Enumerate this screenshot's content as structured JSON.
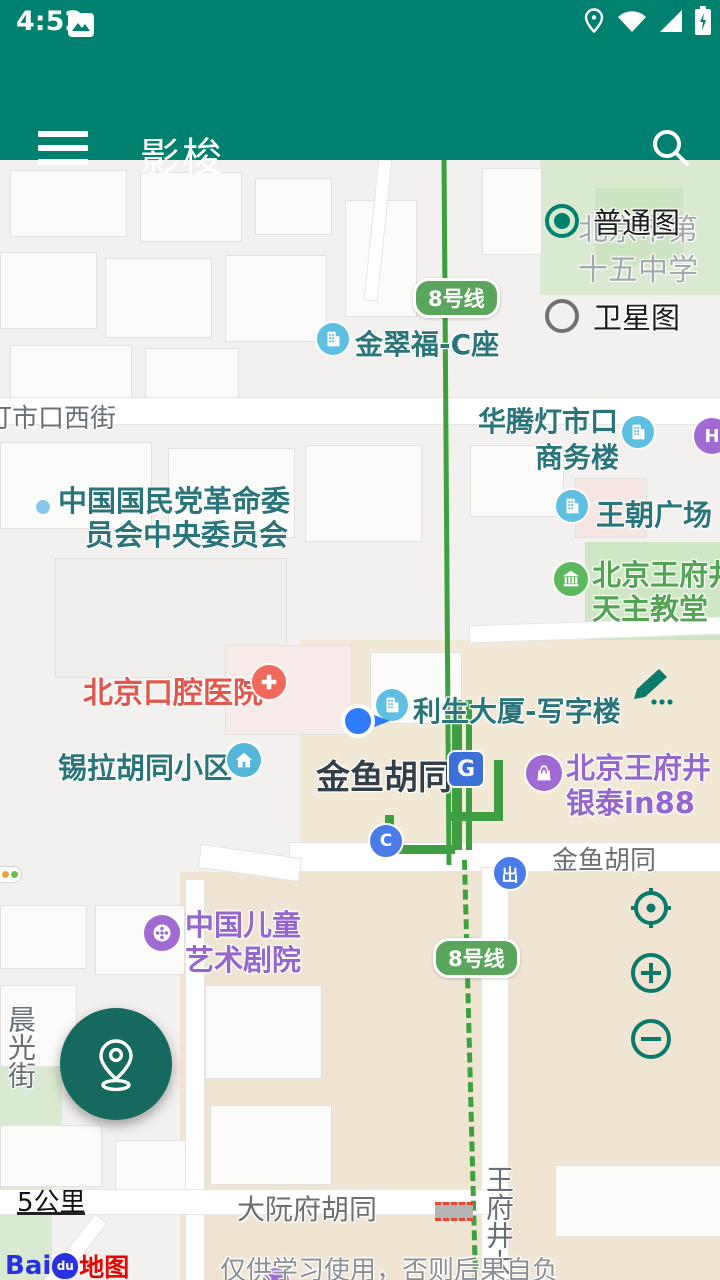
{
  "status_bar": {
    "time": "4:52"
  },
  "app_bar": {
    "title": "影梭"
  },
  "layer_control": {
    "normal": "普通图",
    "satellite": "卫星图"
  },
  "map": {
    "line8_badge": "8号线",
    "labels": {
      "school_line1": "北京市第",
      "school_line2": "十五中学",
      "jincuifu": "金翠福-C座",
      "dengshikou_west_st": "灯市口西街",
      "huateng_line1": "华腾灯市口",
      "huateng_line2": "商务楼",
      "kmt_line1": "中国国民党革命委",
      "kmt_line2": "员会中央委员会",
      "wangchao": "王朝广场",
      "church_line1": "北京王府井",
      "church_line2": "天主教堂",
      "hospital": "北京口腔医院",
      "lisheng": "利生大厦-写字楼",
      "xila": "锡拉胡同小区",
      "station": "金鱼胡同",
      "yintai_line1": "北京王府井",
      "yintai_line2": "银泰in88",
      "jinyu_road": "金鱼胡同",
      "theatre_line1": "中国儿童",
      "theatre_line2": "艺术剧院",
      "chenguang_st": "晨光街",
      "dayuanfu": "大阮府胡同",
      "wangfujing_st": "王府井大街",
      "exit_c": "C",
      "exit_chu": "出",
      "hotel_h": "H",
      "subway_logo_g": "G"
    },
    "scale": "5公里",
    "attribution": {
      "bai": "Bai",
      "du": "du",
      "ditu": "地图"
    },
    "disclaimer": "仅供学习使用，否则后果自负"
  },
  "colors": {
    "header_teal": "#00806E",
    "fab_teal": "#15695E",
    "control_teal": "#0B7A6B",
    "poi_teal": "#2A757B",
    "poi_green": "#55A355",
    "poi_purple": "#9566CE",
    "poi_red": "#E2574C",
    "metro_green": "#3da23d",
    "badge_green": "#5AA65C",
    "exit_blue": "#4A7BE8",
    "icon_blue": "#5FBFE0",
    "subway_logo_blue": "#3D6FD9"
  }
}
